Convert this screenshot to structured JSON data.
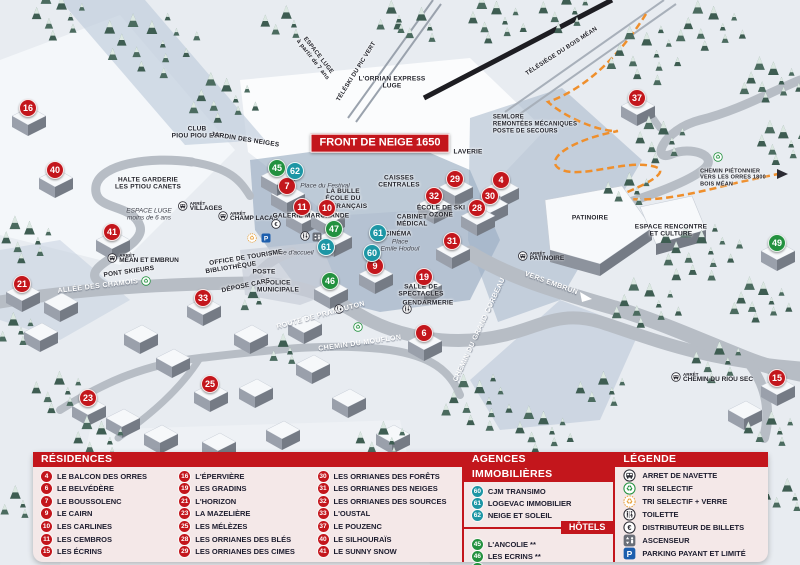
{
  "map": {
    "colors": {
      "red": "#c3161c",
      "green": "#23913f",
      "teal": "#1d96a5",
      "header_red": "#c3161c"
    },
    "banner": "FRONT DE NEIGE 1650",
    "markers": [
      {
        "num": "16",
        "color": "red",
        "x": 28,
        "y": 108
      },
      {
        "num": "40",
        "color": "red",
        "x": 55,
        "y": 170
      },
      {
        "num": "41",
        "color": "red",
        "x": 112,
        "y": 232
      },
      {
        "num": "21",
        "color": "red",
        "x": 22,
        "y": 284
      },
      {
        "num": "7",
        "color": "red",
        "x": 287,
        "y": 186
      },
      {
        "num": "11",
        "color": "red",
        "x": 302,
        "y": 207
      },
      {
        "num": "10",
        "color": "red",
        "x": 327,
        "y": 208
      },
      {
        "num": "9",
        "color": "red",
        "x": 375,
        "y": 266
      },
      {
        "num": "33",
        "color": "red",
        "x": 203,
        "y": 298
      },
      {
        "num": "25",
        "color": "red",
        "x": 210,
        "y": 384
      },
      {
        "num": "23",
        "color": "red",
        "x": 88,
        "y": 398
      },
      {
        "num": "19",
        "color": "red",
        "x": 424,
        "y": 277
      },
      {
        "num": "6",
        "color": "red",
        "x": 424,
        "y": 333
      },
      {
        "num": "32",
        "color": "red",
        "x": 434,
        "y": 196
      },
      {
        "num": "29",
        "color": "red",
        "x": 455,
        "y": 179
      },
      {
        "num": "4",
        "color": "red",
        "x": 501,
        "y": 180
      },
      {
        "num": "30",
        "color": "red",
        "x": 490,
        "y": 196
      },
      {
        "num": "28",
        "color": "red",
        "x": 477,
        "y": 208
      },
      {
        "num": "31",
        "color": "red",
        "x": 452,
        "y": 241
      },
      {
        "num": "37",
        "color": "red",
        "x": 637,
        "y": 98
      },
      {
        "num": "15",
        "color": "red",
        "x": 777,
        "y": 378
      },
      {
        "num": "45",
        "color": "green",
        "x": 277,
        "y": 168
      },
      {
        "num": "47",
        "color": "green",
        "x": 334,
        "y": 229
      },
      {
        "num": "46",
        "color": "green",
        "x": 330,
        "y": 281
      },
      {
        "num": "49",
        "color": "green",
        "x": 777,
        "y": 243
      },
      {
        "num": "62",
        "color": "teal",
        "x": 295,
        "y": 171
      },
      {
        "num": "61",
        "color": "teal",
        "x": 326,
        "y": 247
      },
      {
        "num": "61",
        "color": "teal",
        "x": 378,
        "y": 233
      },
      {
        "num": "60",
        "color": "teal",
        "x": 372,
        "y": 253
      }
    ],
    "labels": [
      {
        "text": "FRONT DE NEIGE 1650",
        "x": 380,
        "y": 143,
        "kind": "banner"
      },
      {
        "text": "L'ORRIAN EXPRESS\nLUGE",
        "x": 392,
        "y": 83,
        "kind": "dark"
      },
      {
        "text": "ESPACE LUGE\nà partir de 7 ans",
        "x": 315,
        "y": 58,
        "rot": 52,
        "kind": "dark",
        "size": 6
      },
      {
        "text": "TÉLÉSKI DU PIC VERT",
        "x": 357,
        "y": 72,
        "rot": -58,
        "kind": "dark",
        "size": 6
      },
      {
        "text": "TÉLÉSIÈGE DU BOIS MÉAN",
        "x": 562,
        "y": 52,
        "rot": -33,
        "kind": "dark",
        "size": 6
      },
      {
        "text": "SEMLORE\nREMONTÉES MÉCANIQUES\nPOSTE DE SECOURS",
        "x": 535,
        "y": 125,
        "kind": "dark",
        "align": "left",
        "size": 6
      },
      {
        "text": "LAVERIE",
        "x": 468,
        "y": 152,
        "kind": "dark"
      },
      {
        "text": "CAISSES\nCENTRALES",
        "x": 399,
        "y": 182,
        "kind": "dark"
      },
      {
        "text": "LA BULLE\nÉCOLE DU\nSKI FRANÇAIS",
        "x": 343,
        "y": 199,
        "kind": "dark"
      },
      {
        "text": "Place du Festival",
        "x": 325,
        "y": 186,
        "kind": "italic"
      },
      {
        "text": "GALERIE MARCHANDE",
        "x": 311,
        "y": 216,
        "kind": "dark"
      },
      {
        "text": "CABINET\nMÉDICAL",
        "x": 412,
        "y": 221,
        "kind": "dark"
      },
      {
        "text": "CINÉMA",
        "x": 398,
        "y": 234,
        "kind": "dark"
      },
      {
        "text": "ÉCOLE DE SKI\nOZONE",
        "x": 441,
        "y": 212,
        "kind": "dark"
      },
      {
        "text": "Place\nEmile Hodoul",
        "x": 400,
        "y": 246,
        "kind": "italic"
      },
      {
        "text": "Place d'accueil",
        "x": 292,
        "y": 253,
        "kind": "italic"
      },
      {
        "text": "OFFICE DE TOURISME",
        "x": 246,
        "y": 258,
        "rot": -9,
        "kind": "dark"
      },
      {
        "text": "BIBLIOTHÈQUE",
        "x": 231,
        "y": 268,
        "rot": -9,
        "kind": "dark"
      },
      {
        "text": "POSTE",
        "x": 264,
        "y": 272,
        "kind": "dark"
      },
      {
        "text": "POLICE\nMUNICIPALE",
        "x": 278,
        "y": 287,
        "kind": "dark"
      },
      {
        "text": "DÉPOSE CARS",
        "x": 246,
        "y": 286,
        "rot": -12,
        "kind": "dark"
      },
      {
        "text": "SALLE DE\nSPECTACLES",
        "x": 421,
        "y": 291,
        "kind": "dark"
      },
      {
        "text": "GENDARMERIE",
        "x": 428,
        "y": 303,
        "kind": "dark"
      },
      {
        "text": "PATINOIRE",
        "x": 590,
        "y": 218,
        "kind": "dark"
      },
      {
        "text": "ESPACE RENCONTRE\nET CULTURE",
        "x": 671,
        "y": 231,
        "kind": "dark"
      },
      {
        "text": "HALTE GARDERIE\nLES PTIOU CANETS",
        "x": 148,
        "y": 184,
        "kind": "dark"
      },
      {
        "text": "CLUB\nPIOU PIOU ESF",
        "x": 197,
        "y": 133,
        "kind": "dark"
      },
      {
        "text": "JARDIN DES NEIGES",
        "x": 245,
        "y": 140,
        "rot": 9,
        "kind": "dark"
      },
      {
        "text": "ESPACE LUGE\nmoins de 6 ans",
        "x": 149,
        "y": 215,
        "kind": "italic"
      },
      {
        "text": "ALLÉE DES CHAMOIS",
        "x": 98,
        "y": 287,
        "rot": -7,
        "kind": "road"
      },
      {
        "text": "PONT SKIEURS",
        "x": 129,
        "y": 272,
        "rot": -8,
        "kind": "dark"
      },
      {
        "text": "ROUTE DE PRAMOUTON",
        "x": 321,
        "y": 316,
        "rot": -15,
        "kind": "road"
      },
      {
        "text": "CHEMIN DU MOUFLON",
        "x": 360,
        "y": 344,
        "rot": -8,
        "kind": "road"
      },
      {
        "text": "CHEMIN DU GRAND CORBEAU",
        "x": 480,
        "y": 330,
        "rot": -65,
        "kind": "road"
      },
      {
        "text": "VERS EMBRUN",
        "x": 551,
        "y": 284,
        "rot": 20,
        "kind": "road"
      },
      {
        "text": "CHEMIN PIÉTONNIER\nVERS LES ORRES 1800\nBOIS MÉAN",
        "x": 733,
        "y": 178,
        "kind": "dark",
        "align": "left",
        "size": 5.5
      }
    ],
    "bus_stops": [
      {
        "prefix": "ARRÊT",
        "name": "VILLAGES",
        "x": 200,
        "y": 207
      },
      {
        "prefix": "ARRÊT",
        "name": "CHAMP LACAS",
        "x": 248,
        "y": 217
      },
      {
        "prefix": "ARRÊT",
        "name": "MÉAN ET EMBRUN",
        "x": 143,
        "y": 259
      },
      {
        "prefix": "ARRÊT",
        "name": "PATINOIRE",
        "x": 541,
        "y": 257
      },
      {
        "prefix": "ARRÊT",
        "name": "CHEMIN DU RIOU SEC",
        "x": 712,
        "y": 378
      }
    ],
    "icons": [
      {
        "type": "recycle-green",
        "x": 146,
        "y": 281
      },
      {
        "type": "recycle-green",
        "x": 358,
        "y": 327
      },
      {
        "type": "recycle-green",
        "x": 718,
        "y": 157
      },
      {
        "type": "recycle-yellow",
        "x": 252,
        "y": 238
      },
      {
        "type": "parking",
        "x": 266,
        "y": 238
      },
      {
        "type": "euro",
        "x": 276,
        "y": 224
      },
      {
        "type": "wc",
        "x": 305,
        "y": 236
      },
      {
        "type": "elevator",
        "x": 317,
        "y": 237
      },
      {
        "type": "wc",
        "x": 339,
        "y": 309
      },
      {
        "type": "wc",
        "x": 407,
        "y": 309
      }
    ]
  },
  "legend": {
    "residences": {
      "title": "RÉSIDENCES",
      "items": [
        {
          "num": "4",
          "label": "LE BALCON DES ORRES"
        },
        {
          "num": "6",
          "label": "LE BELVÉDÈRE"
        },
        {
          "num": "7",
          "label": "LE BOUSSOLENC"
        },
        {
          "num": "9",
          "label": "LE CAIRN"
        },
        {
          "num": "10",
          "label": "LES CARLINES"
        },
        {
          "num": "11",
          "label": "LES CEMBROS"
        },
        {
          "num": "15",
          "label": "LES ÉCRINS"
        },
        {
          "num": "16",
          "label": "L'ÉPERVIÈRE"
        },
        {
          "num": "19",
          "label": "LES GRADINS"
        },
        {
          "num": "21",
          "label": "L'HORIZON"
        },
        {
          "num": "23",
          "label": "LA MAZELIÈRE"
        },
        {
          "num": "25",
          "label": "LES MÉLÈZES"
        },
        {
          "num": "28",
          "label": "LES ORRIANES DES BLÉS"
        },
        {
          "num": "29",
          "label": "LES ORRIANES DES CIMES"
        },
        {
          "num": "30",
          "label": "LES ORRIANES DES FORÊTS"
        },
        {
          "num": "31",
          "label": "LES ORRIANES DES NEIGES"
        },
        {
          "num": "32",
          "label": "LES ORRIANES DES SOURCES"
        },
        {
          "num": "33",
          "label": "L'OUSTAL"
        },
        {
          "num": "37",
          "label": "LE POUZENC"
        },
        {
          "num": "40",
          "label": "LE SILHOURAÏS"
        },
        {
          "num": "41",
          "label": "LE SUNNY SNOW"
        }
      ]
    },
    "agences": {
      "title": "AGENCES IMMOBILIÈRES",
      "items": [
        {
          "num": "60",
          "label": "CJM TRANSIMO"
        },
        {
          "num": "61",
          "label": "LOGEVAC IMMOBILIER"
        },
        {
          "num": "62",
          "label": "NEIGE ET SOLEIL"
        }
      ]
    },
    "hotels": {
      "title": "HÔTELS",
      "items": [
        {
          "num": "45",
          "label": "L'ANCOLIE **"
        },
        {
          "num": "46",
          "label": "LES ECRINS **"
        },
        {
          "num": "47",
          "label": "L'ESCALE BLANCHE ***"
        },
        {
          "num": "49",
          "label": "LES TRAPPEURS **"
        }
      ]
    },
    "legende": {
      "title": "LÉGENDE",
      "items": [
        {
          "icon": "bus",
          "label": "ARRET DE NAVETTE"
        },
        {
          "icon": "recycle-green",
          "label": "TRI SELECTIF"
        },
        {
          "icon": "recycle-yellow",
          "label": "TRI SELECTIF + VERRE"
        },
        {
          "icon": "wc",
          "label": "TOILETTE"
        },
        {
          "icon": "euro",
          "label": "DISTRIBUTEUR DE BILLETS"
        },
        {
          "icon": "elevator",
          "label": "ASCENSEUR"
        },
        {
          "icon": "parking",
          "label": "PARKING PAYANT ET LIMITÉ"
        }
      ]
    }
  }
}
